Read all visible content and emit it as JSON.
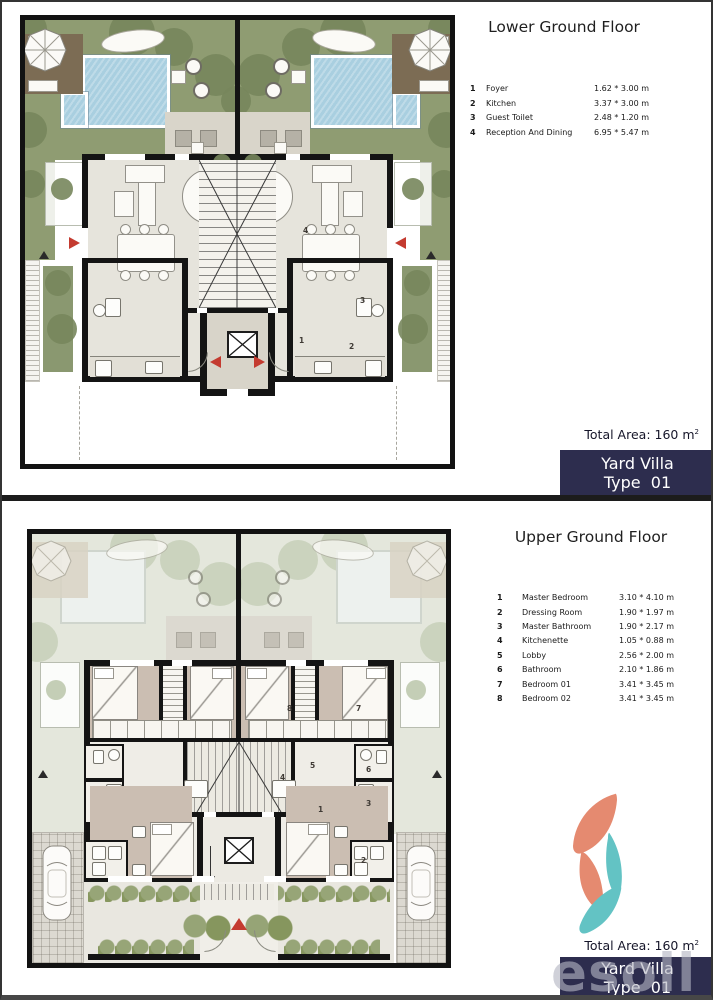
{
  "colors": {
    "badge_bg": "#2d2d4e",
    "arrow_red": "#c43b30",
    "pool_blue": "#a9cfe0",
    "garden_green": "#8f9c72",
    "logo_salmon": "#e58a70",
    "logo_teal": "#63c3c4"
  },
  "panels": [
    {
      "title": "Lower Ground Floor",
      "legend": [
        {
          "num": "1",
          "name": "Foyer",
          "dims": "1.62 * 3.00 m"
        },
        {
          "num": "2",
          "name": "Kitchen",
          "dims": "3.37 * 3.00 m"
        },
        {
          "num": "3",
          "name": "Guest Toilet",
          "dims": "2.48 * 1.20 m"
        },
        {
          "num": "4",
          "name": "Reception And Dining",
          "dims": "6.95 * 5.47 m"
        }
      ],
      "total_area_label": "Total Area: 160 m",
      "total_area_sup": "2",
      "badge": {
        "line1": "Yard Villa",
        "line2": "Type  01"
      },
      "markers": [
        "1",
        "2",
        "3",
        "4"
      ]
    },
    {
      "title": "Upper Ground Floor",
      "legend": [
        {
          "num": "1",
          "name": "Master Bedroom",
          "dims": "3.10 * 4.10 m"
        },
        {
          "num": "2",
          "name": "Dressing Room",
          "dims": "1.90 * 1.97 m"
        },
        {
          "num": "3",
          "name": "Master Bathroom",
          "dims": "1.90 * 2.17 m"
        },
        {
          "num": "4",
          "name": "Kitchenette",
          "dims": "1.05 * 0.88 m"
        },
        {
          "num": "5",
          "name": "Lobby",
          "dims": "2.56 * 2.00 m"
        },
        {
          "num": "6",
          "name": "Bathroom",
          "dims": "2.10 * 1.86 m"
        },
        {
          "num": "7",
          "name": "Bedroom 01",
          "dims": "3.41 * 3.45 m"
        },
        {
          "num": "8",
          "name": "Bedroom 02",
          "dims": "3.41 * 3.45 m"
        }
      ],
      "total_area_label": "Total Area: 160 m",
      "total_area_sup": "2",
      "badge": {
        "line1": "Yard Villa",
        "line2": "Type  01"
      },
      "markers": [
        "1",
        "2",
        "3",
        "4",
        "5",
        "6",
        "7",
        "8"
      ],
      "watermark": "esoll"
    }
  ]
}
